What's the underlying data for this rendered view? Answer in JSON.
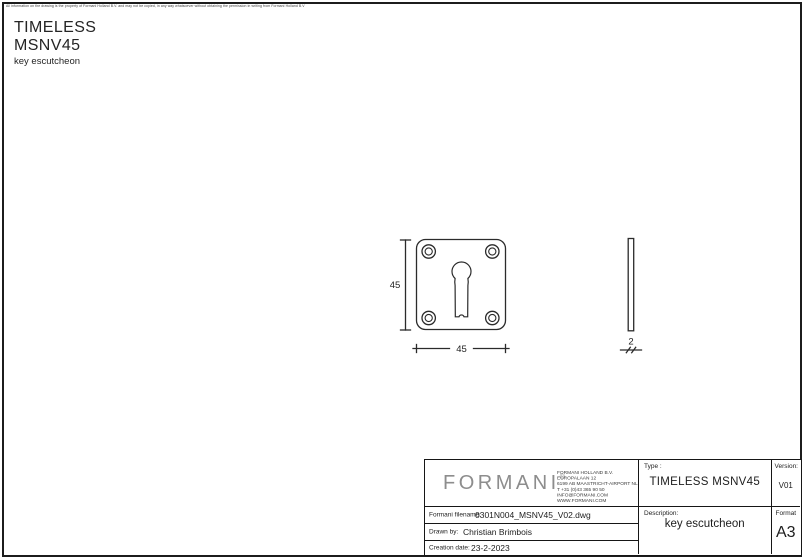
{
  "page": {
    "disclaimer": "All information on the drawing is the property of Formani Holland B.V. and may not be copied, in any way whatsoever without obtaining the permission in writing from Formani Holland B.V",
    "title_line1": "TIMELESS",
    "title_line2": "MSNV45",
    "subtitle": "key escutcheon"
  },
  "drawing": {
    "front_view": {
      "shape": "square escutcheon plate with rounded corners, four screw holes and central keyhole",
      "width_label": "45",
      "height_label": "45"
    },
    "side_view": {
      "shape": "thin plate profile",
      "thickness_label": "2"
    }
  },
  "title_block": {
    "logo_text": "FORMANI",
    "logo_registered": "®",
    "company_lines": [
      "FORMANI HOLLAND B.V.",
      "EUROPALAAN 12",
      "6199 AB MAASTRICHT-AIRPORT NL",
      "T +31 (0)43 365 90 50",
      "INFO@FORMANI.COM",
      "WWW.FORMANI.COM"
    ],
    "type": {
      "label": "Type :",
      "value": "TIMELESS MSNV45"
    },
    "version": {
      "label": "Version:",
      "value": "V01"
    },
    "filename": {
      "label": "Formani filename:",
      "value": "0301N004_MSNV45_V02.dwg"
    },
    "drawn_by": {
      "label": "Drawn by:",
      "value": "Christian Brimbois"
    },
    "creation_date": {
      "label": "Creation date:",
      "value": "23-2-2023"
    },
    "description": {
      "label": "Description:",
      "value": "key escutcheon"
    },
    "format": {
      "label": "Format",
      "value": "A3"
    }
  },
  "colors": {
    "background": "#ffffff",
    "line": "#2b2b2b",
    "border": "#1c1c1c",
    "logo_gray": "#8d8d8d"
  }
}
